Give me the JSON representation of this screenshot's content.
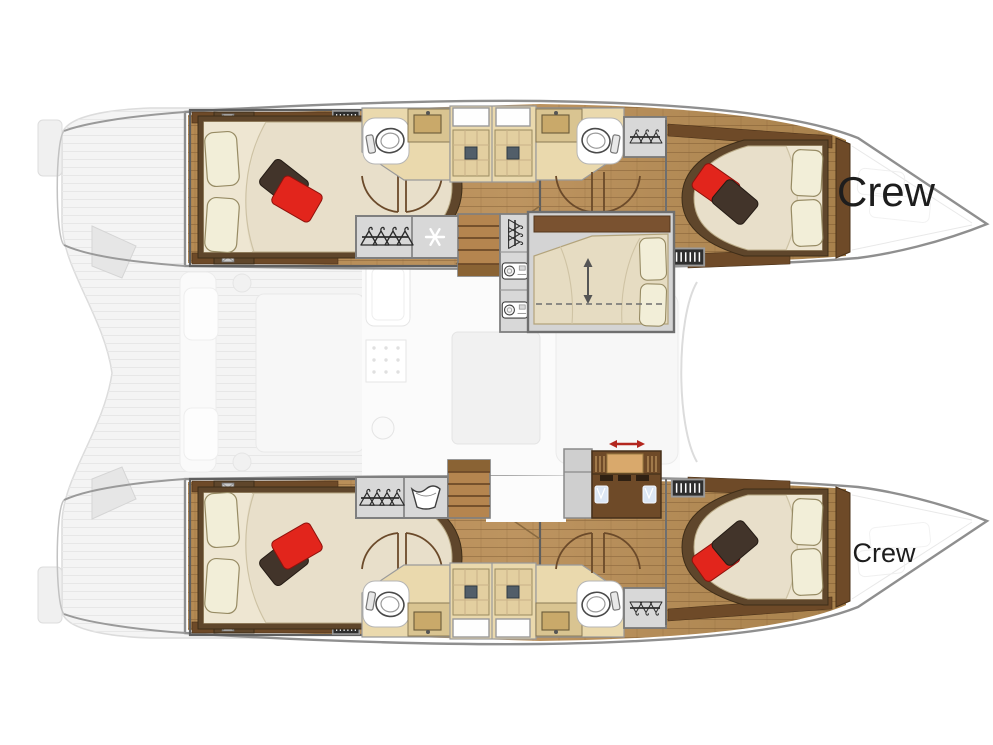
{
  "diagram": {
    "type": "catamaran-floor-plan",
    "orientation": "bow-right",
    "labels": {
      "crew_top": "Crew",
      "crew_bottom": "Crew"
    }
  },
  "colors": {
    "background": "#ffffff",
    "hull_outline": "#8f8f8f",
    "wood_floor": "#b48b57",
    "wood_trim": "#6e4a28",
    "bathroom_floor": "#ead9ad",
    "shower_tile": "#e3cfa0",
    "cabinet_gray": "#d8d8d8",
    "mattress": "#e8dfca",
    "pillow_cream": "#f2eed8",
    "pillow_red": "#e2251c",
    "pillow_brown": "#42342a",
    "ghost_deck": "#f4f4f4",
    "label_text": "#1d1d1d",
    "arrow_red": "#b3261e"
  },
  "icons": {
    "wardrobe": "hangers-on-rail-icon",
    "fridge": "snowflake-icon",
    "washer": "washing-machine-icon",
    "washbasin": "washbasin-icon",
    "toilet": "toilet-icon",
    "stairs": "stairs-icon",
    "bed_convert": "double-arrow-icon",
    "sliding_door": "red-double-arrow-icon",
    "vent": "vent-grill-icon"
  }
}
